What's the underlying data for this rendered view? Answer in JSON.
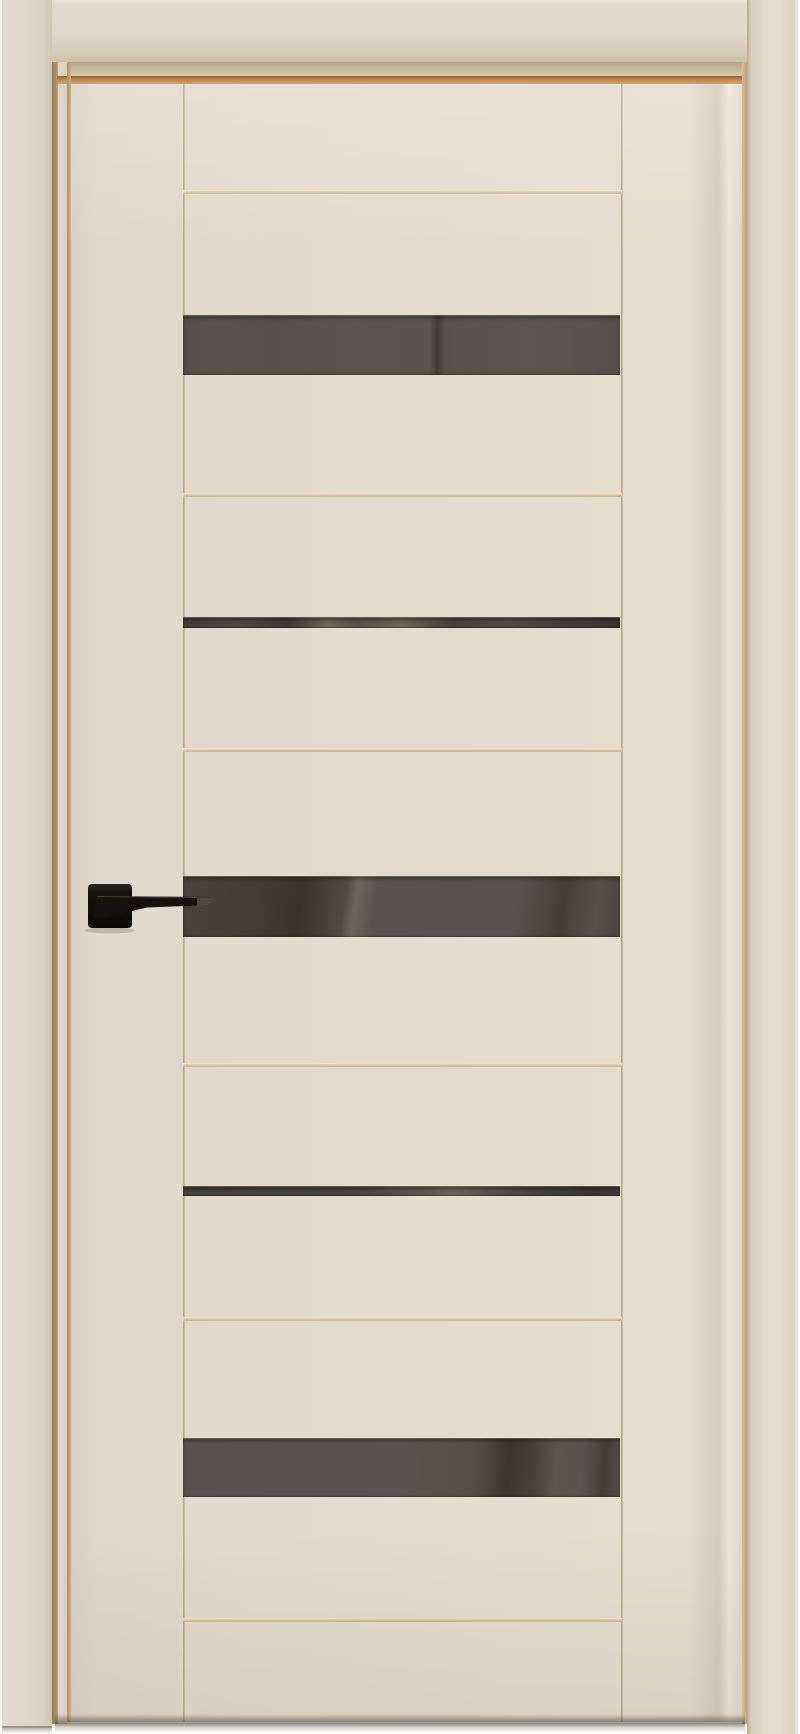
{
  "scene": {
    "type": "product-photo",
    "subject": "Closed interior door in an ivory/cream painted finish, shown with matching door frame. The leaf has five horizontal dark smoked-glass inserts (three wide, two narrow) separated by cream rails with thin tan seam grooves, and a matte black square-rose lever handle on the left stile pointing right.",
    "background_color": "#ffffff"
  },
  "palette": {
    "casing": "#ded7c8",
    "casing_shadow": "#cbc1a9",
    "leaf": "#e3dcce",
    "groove_dark": "#8d7a58",
    "reveal_tan": "#cfb286",
    "reveal_orange": "#c08450",
    "seam_tan": "#d8c096",
    "glass_gray": "#575150",
    "glass_brown": "#443a33",
    "handle_black": "#14110e",
    "under_door_shadow": "#3c352a"
  },
  "frame": {
    "head_casing": {
      "x": 2,
      "y": 0,
      "width": 748,
      "height": 62
    },
    "left_casing": {
      "x": 2,
      "y": 0,
      "width": 50,
      "height": 1728
    },
    "right_casing": {
      "x": 747,
      "y": 0,
      "width": 51,
      "height": 1734
    }
  },
  "leaf": {
    "x": 71,
    "y": 84,
    "width": 671,
    "height": 1638,
    "stile_seams_x": [
      112,
      550
    ],
    "rail_seams_y": [
      106,
      409,
      664,
      979,
      1233,
      1534
    ],
    "inner_left": 112,
    "inner_width": 439
  },
  "glass_strips": [
    {
      "name": "glass-strip-1",
      "top": 231,
      "height": 60,
      "gradient": "linear-gradient(90deg,#514b49 0%,#585250 6%,#554f4d 20%,#5a5452 38%,#595351 56.5%,#403a38 58.2%,#575150 60%,#5b5553 78%,#595351 92%,#544e4c 100%)"
    },
    {
      "name": "glass-strip-2",
      "top": 533,
      "height": 11,
      "gradient": "linear-gradient(90deg,#403a37 0%,#4f4944 12%,#3e3834 24%,#6f6359 33%,#57504a 40%,#6e6257 50%,#473f3b 62%,#524b45 74%,#453e3a 86%,#393330 100%)"
    },
    {
      "name": "glass-strip-3",
      "top": 792,
      "height": 61,
      "gradient": "linear-gradient(98deg,#4b413d 0%,#453b37 18%,#3c332f 27%,#514843 37%,#6e665f 39.5%,#595250 44%,#575150 60%,#585150 76%,#463d38 86%,#564f4c 94%,#4b433f 100%)"
    },
    {
      "name": "glass-strip-4",
      "top": 1102,
      "height": 10,
      "gradient": "linear-gradient(90deg,#45403e 0%,#4a4441 40%,#5e564e 56%,#6d6259 62%,#584f49 70%,#453f3b 82%,#3a3431 94%,#423c39 100%)"
    },
    {
      "name": "glass-strip-5",
      "top": 1354,
      "height": 59,
      "gradient": "linear-gradient(94deg,#575150 0%,#595351 50%,#564e4a 66%,#3f3631 74%,#4a403a 80%,#5c5450 85%,#585250 91%,#463d38 96%,#544c49 100%)"
    }
  ],
  "handle": {
    "style": "matte-black square-rose lever handle, lever pointing right over glass strip 3",
    "x": 14,
    "y": 796,
    "width": 130,
    "height": 50,
    "rose": {
      "x": 3,
      "y": 4,
      "size": 44,
      "radius": 4
    },
    "lever_points": "9,16 126,17 126,25 62,27.5 14,38.5 9,38",
    "tip_highlight_points": "112,17.2 126,17.4 126,24.8 112,26",
    "grip_highlight": {
      "x1": 12,
      "y1": 16.6,
      "x2": 124,
      "y2": 17.6
    }
  }
}
